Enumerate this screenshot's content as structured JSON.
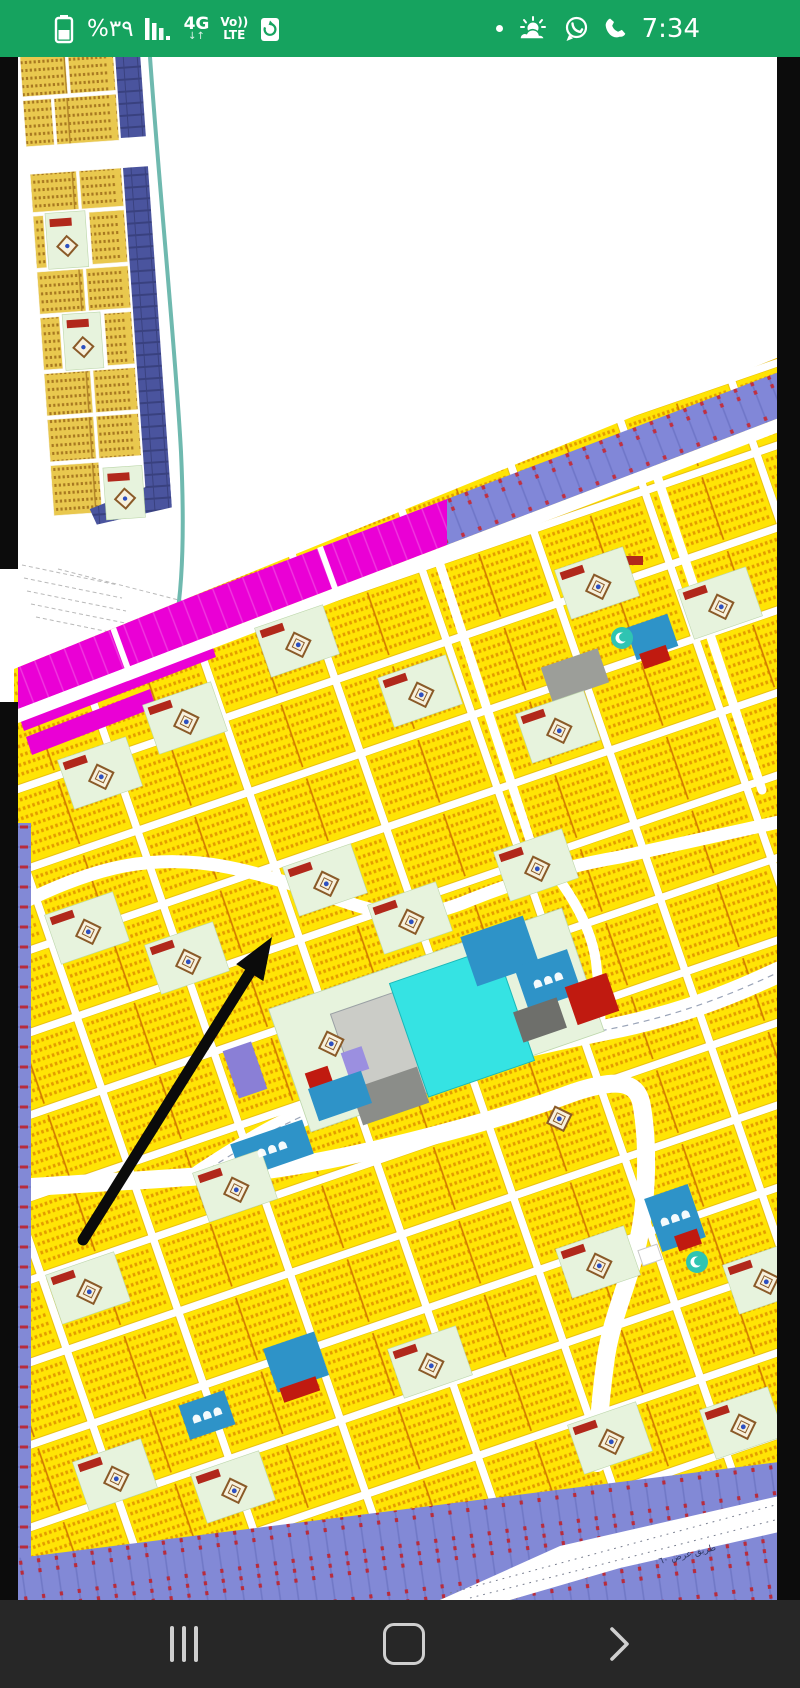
{
  "status_bar": {
    "bg_color": "#16a35f",
    "battery_percent": "%٣٩",
    "network": "4G",
    "updown_arrows": "↓↑",
    "volte_top": "Vo))",
    "volte_bottom": "LTE",
    "time": "7:34",
    "left_icons": [
      "battery-icon",
      "signal-bars-icon",
      "network-4g-label",
      "volte-label",
      "battery-saver-icon"
    ],
    "right_icons": [
      "notification-dot",
      "weather-icon",
      "whatsapp-icon",
      "call-icon"
    ]
  },
  "nav_bar": {
    "bg_color": "#272727",
    "icons": [
      "recents-icon",
      "home-icon",
      "back-icon"
    ]
  },
  "map": {
    "description": "Photo of a cadastral master-plan: yellow residential plot blocks on a rotated street grid, green mosque courtyards, blue service buildings, cyan pool, magenta and purple road bands, annotated with a hand-drawn black arrow",
    "road_label": "طريق عرض ٦٠",
    "colors": {
      "plot_yellow": "#ffe405",
      "plot_tick": "#e39c00",
      "district_yellow": "#e9c84e",
      "district_tick": "#a87820",
      "navy_strip": "#4a549e",
      "teal_line": "#6fb9af",
      "magenta_road": "#ea00d5",
      "band_purple": "#8187d8",
      "periwinkle_strip": "#8289d6",
      "steel_blue": "#2e93c8",
      "cyan_pool": "#35e3e3",
      "brick_red": "#c01a10",
      "courtyard_green": "#e7f3dd",
      "gray_lot": "#9c9e99",
      "light_gray_lot": "#cbccc7",
      "lavender": "#9b8fe0",
      "photo_edge_black": "#0c0c0c",
      "road_white": "#ffffff"
    },
    "annotation_arrow": {
      "x1": 83,
      "y1": 1183,
      "x2": 272,
      "y2": 880,
      "color": "#0b0b0b"
    },
    "courtyards": [
      {
        "x": 297,
        "y": 584
      },
      {
        "x": 420,
        "y": 634
      },
      {
        "x": 185,
        "y": 661
      },
      {
        "x": 558,
        "y": 670
      },
      {
        "x": 100,
        "y": 716
      },
      {
        "x": 720,
        "y": 546
      },
      {
        "x": 597,
        "y": 526
      },
      {
        "x": 87,
        "y": 871
      },
      {
        "x": 187,
        "y": 901
      },
      {
        "x": 325,
        "y": 823
      },
      {
        "x": 410,
        "y": 861
      },
      {
        "x": 536,
        "y": 808
      },
      {
        "x": 330,
        "y": 983,
        "plain": true
      },
      {
        "x": 558,
        "y": 1058,
        "plain": true
      },
      {
        "x": 235,
        "y": 1129
      },
      {
        "x": 598,
        "y": 1205
      },
      {
        "x": 765,
        "y": 1221
      },
      {
        "x": 88,
        "y": 1231
      },
      {
        "x": 430,
        "y": 1305
      },
      {
        "x": 115,
        "y": 1418
      },
      {
        "x": 233,
        "y": 1430
      },
      {
        "x": 610,
        "y": 1381
      },
      {
        "x": 742,
        "y": 1366
      }
    ],
    "dome_buildings": [
      {
        "x": 272,
        "y": 1092
      },
      {
        "x": 207,
        "y": 1358
      },
      {
        "x": 675,
        "y": 1161
      },
      {
        "x": 548,
        "y": 923
      }
    ]
  }
}
